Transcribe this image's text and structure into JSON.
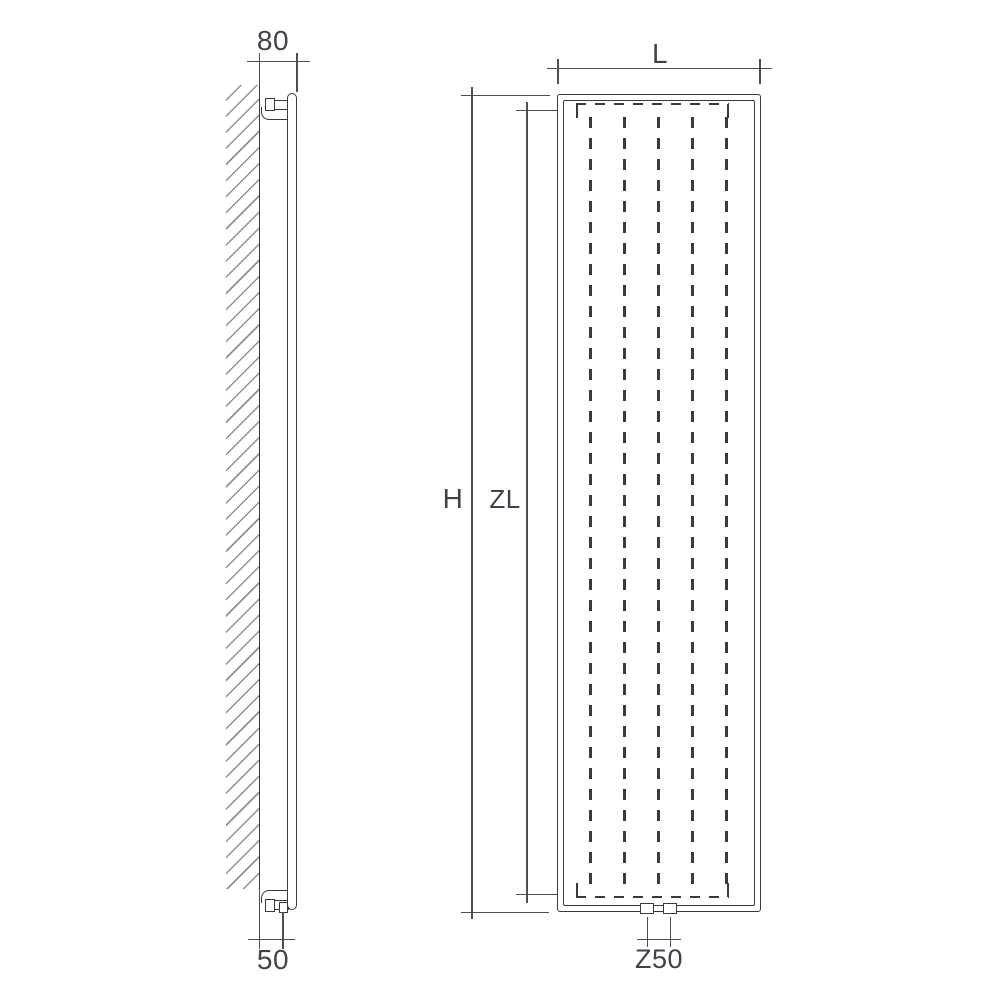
{
  "side_view": {
    "top_dimension": "80",
    "bottom_dimension": "50"
  },
  "front_view": {
    "width_dimension": "L",
    "height_dimension": "H",
    "inner_height_dimension": "ZL",
    "connection_dimension": "Z50"
  },
  "colors": {
    "background": "#ffffff",
    "line": "#3a3a3a",
    "dim": "#4f4f4f",
    "hatch": "#8f8f8f",
    "label": "#41414c"
  }
}
